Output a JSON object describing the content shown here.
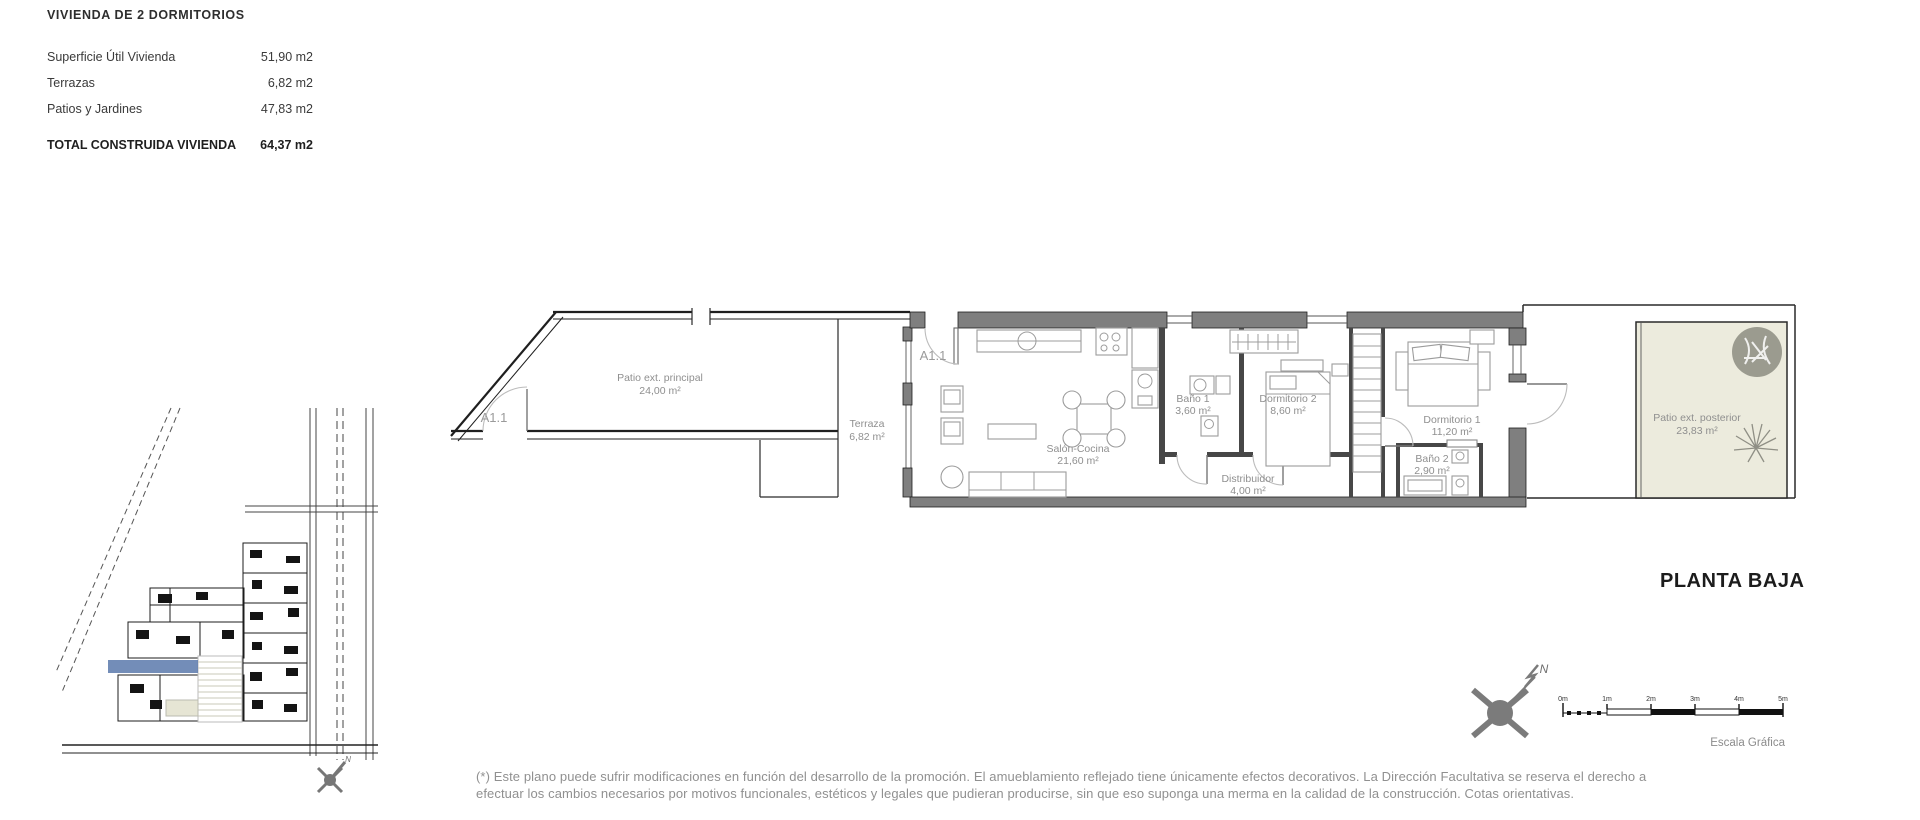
{
  "summary_table": {
    "title": "VIVIENDA DE 2 DORMITORIOS",
    "rows": [
      {
        "label": "Superficie Útil Vivienda",
        "value": "51,90 m2"
      },
      {
        "label": "Terrazas",
        "value": "6,82 m2"
      },
      {
        "label": "Patios y Jardines",
        "value": "47,83 m2"
      }
    ],
    "total": {
      "label": "TOTAL CONSTRUIDA VIVIENDA",
      "value": "64,37 m2"
    }
  },
  "floor_plan": {
    "unit_label": "A1.1",
    "rooms": [
      {
        "name": "Patio ext. principal",
        "area": "24,00 m²"
      },
      {
        "name": "Terraza",
        "area": "6,82 m²"
      },
      {
        "name": "Salón-Cocina",
        "area": "21,60 m²"
      },
      {
        "name": "Baño 1",
        "area": "3,60 m²"
      },
      {
        "name": "Dormitorio 2",
        "area": "8,60 m²"
      },
      {
        "name": "Distribuidor",
        "area": "4,00 m²"
      },
      {
        "name": "Dormitorio 1",
        "area": "11,20 m²"
      },
      {
        "name": "Baño 2",
        "area": "2,90 m²"
      },
      {
        "name": "Patio ext. posterior",
        "area": "23,83 m²"
      }
    ]
  },
  "plan_title": "PLANTA BAJA",
  "compass": {
    "north_label": "N"
  },
  "site_plan": {
    "north_label": "N"
  },
  "scale_bar": {
    "labels": [
      "0m",
      "1m",
      "2m",
      "3m",
      "4m",
      "5m"
    ],
    "caption": "Escala Gráfica"
  },
  "footnote": {
    "line1": "(*) Este plano puede sufrir modificaciones en función del desarrollo de la promoción. El amueblamiento reflejado tiene únicamente efectos decorativos. La Dirección Facultativa se reserva el derecho a",
    "line2": "efectuar los cambios necesarios por motivos funcionales, estéticos y legales que pudieran producirse, sin que eso suponga una merma en la calidad de la construcción. Cotas orientativas."
  },
  "colors": {
    "wall_gray": "#7f7f7f",
    "line_dark": "#1f1f1f",
    "furniture_gray": "#9c9c9c",
    "label_gray": "#8f8f8f",
    "patio_fill": "#ecebdd",
    "highlight_blue": "#5b79ab",
    "compass_gray": "#7b7b7b"
  }
}
